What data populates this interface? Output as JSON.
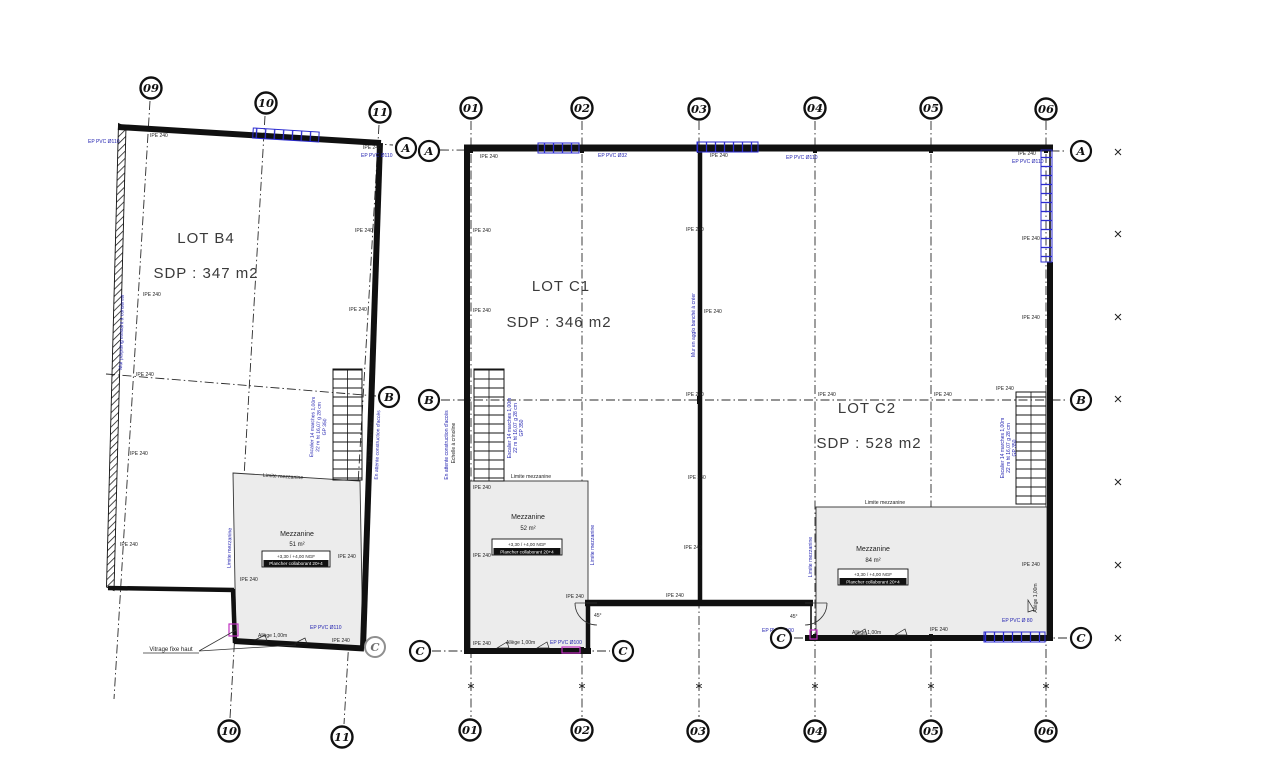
{
  "colors": {
    "annotation_blue": "#1c1cae",
    "door_magenta": "#c030c0",
    "wall_ink": "#101010",
    "mezzanine_fill": "#ececec",
    "glazing_blue": "#2b2bd0"
  },
  "lots": [
    {
      "name": "LOT B4",
      "sdp": "SDP : 347 m2"
    },
    {
      "name": "LOT C1",
      "sdp": "SDP : 346 m2"
    },
    {
      "name": "LOT C2",
      "sdp": "SDP : 528 m2"
    }
  ],
  "mezzanines": [
    {
      "title": "Mezzanine",
      "area": "51 m²",
      "level": "+3,30 / +4,00 NGF",
      "floor": "Plancher collaborant 20+4"
    },
    {
      "title": "Mezzanine",
      "area": "52 m²",
      "level": "+3,30 / +4,00 NGF",
      "floor": "Plancher collaborant 20+4"
    },
    {
      "title": "Mezzanine",
      "area": "84 m²",
      "level": "+3,30 / +4,00 NGF",
      "floor": "Plancher collaborant 20+4"
    }
  ],
  "grid": {
    "cols_left": [
      "09",
      "10",
      "11"
    ],
    "cols_right": [
      "01",
      "02",
      "03",
      "04",
      "05",
      "06"
    ],
    "rows": [
      "A",
      "B",
      "C"
    ]
  },
  "ann": {
    "ipe": "IPE 240",
    "ep110": "EP PVC Ø110",
    "ep100": "EP PVC Ø100",
    "ep32": "EP PVC Ø32",
    "ep80": "EP PVC Ø 80",
    "allege": "Allège 1,00m",
    "limite": "Limite mezzanine",
    "vitrage": "Vitrage fixe haut",
    "echelle": "Echelle à crinoline",
    "attente": "En attente construction d'accès",
    "gp": "GP 350",
    "esc1": "Escalier 14 marches 1,00m",
    "esc2": "22 m ht 16,07 g 28 cm",
    "mur_agglo": "Mur en agglo banché à créer",
    "mur_parpaing": "Mur parpaing existant à conserver",
    "deg": "45°"
  }
}
